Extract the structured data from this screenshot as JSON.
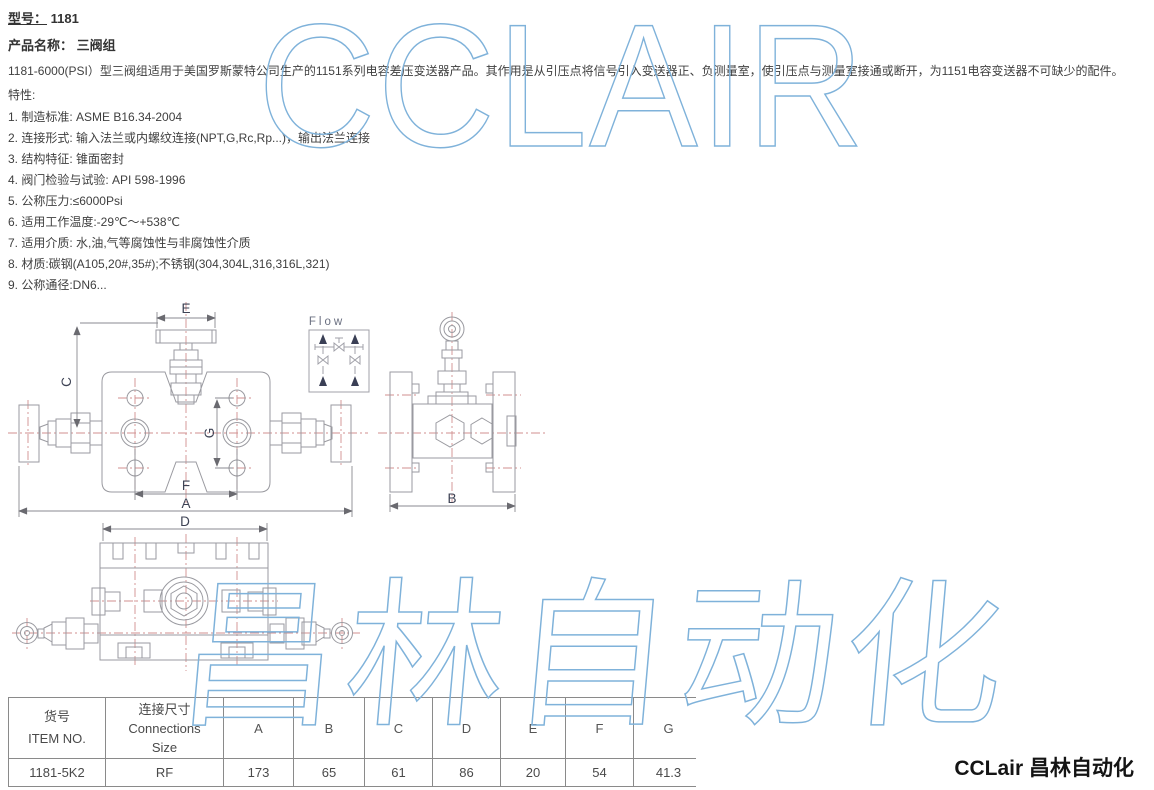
{
  "header": {
    "model_label": "型号：",
    "model_value": "1181",
    "product_label": "产品名称：",
    "product_value": "三阀组",
    "description": "1181-6000(PSI）型三阀组适用于美国罗斯蒙特公司生产的1151系列电容差压变送器产品。其作用是从引压点将信号引入变送器正、负测量室，使引压点与测量室接通或断开，为1151电容变送器不可缺少的配件。",
    "features_label": "特性:"
  },
  "features": [
    "1. 制造标准: ASME B16.34-2004",
    "2. 连接形式: 输入法兰或内螺纹连接(NPT,G,Rc,Rp...)，输出法兰连接",
    "3. 结构特征: 锥面密封",
    "4. 阀门检验与试验: API 598-1996",
    "5. 公称压力:≤6000Psi",
    "6. 适用工作温度:-29℃～+538℃",
    "7. 适用介质: 水,油,气等腐蚀性与非腐蚀性介质",
    "8. 材质:碳钢(A105,20#,35#);不锈钢(304,304L,316,316L,321)",
    "9. 公称通径:DN6..."
  ],
  "drawing": {
    "labels": {
      "e": "E",
      "c": "C",
      "g": "G",
      "f": "F",
      "a": "A",
      "d": "D",
      "b": "B",
      "flow": "Flow"
    },
    "line_color": "#9a9aa0",
    "centerline_color": "#d08f8f",
    "label_color": "#3d4254"
  },
  "table": {
    "item_no_header": {
      "line1": "货号",
      "line2": "ITEM NO."
    },
    "connection_header": {
      "line1": "连接尺寸",
      "line2": "Connections",
      "line3": "Size"
    },
    "dim_headers": [
      "A",
      "B",
      "C",
      "D",
      "E",
      "F",
      "G"
    ],
    "row": {
      "item_no": "1181-5K2",
      "connection": "RF",
      "values": [
        "173",
        "65",
        "61",
        "86",
        "20",
        "54",
        "41.3"
      ]
    }
  },
  "watermark": {
    "top": "CCLAIR",
    "bottom": "昌林自动化",
    "color": "#7fb2da"
  },
  "footer": {
    "brand": "CCLair 昌林自动化"
  }
}
